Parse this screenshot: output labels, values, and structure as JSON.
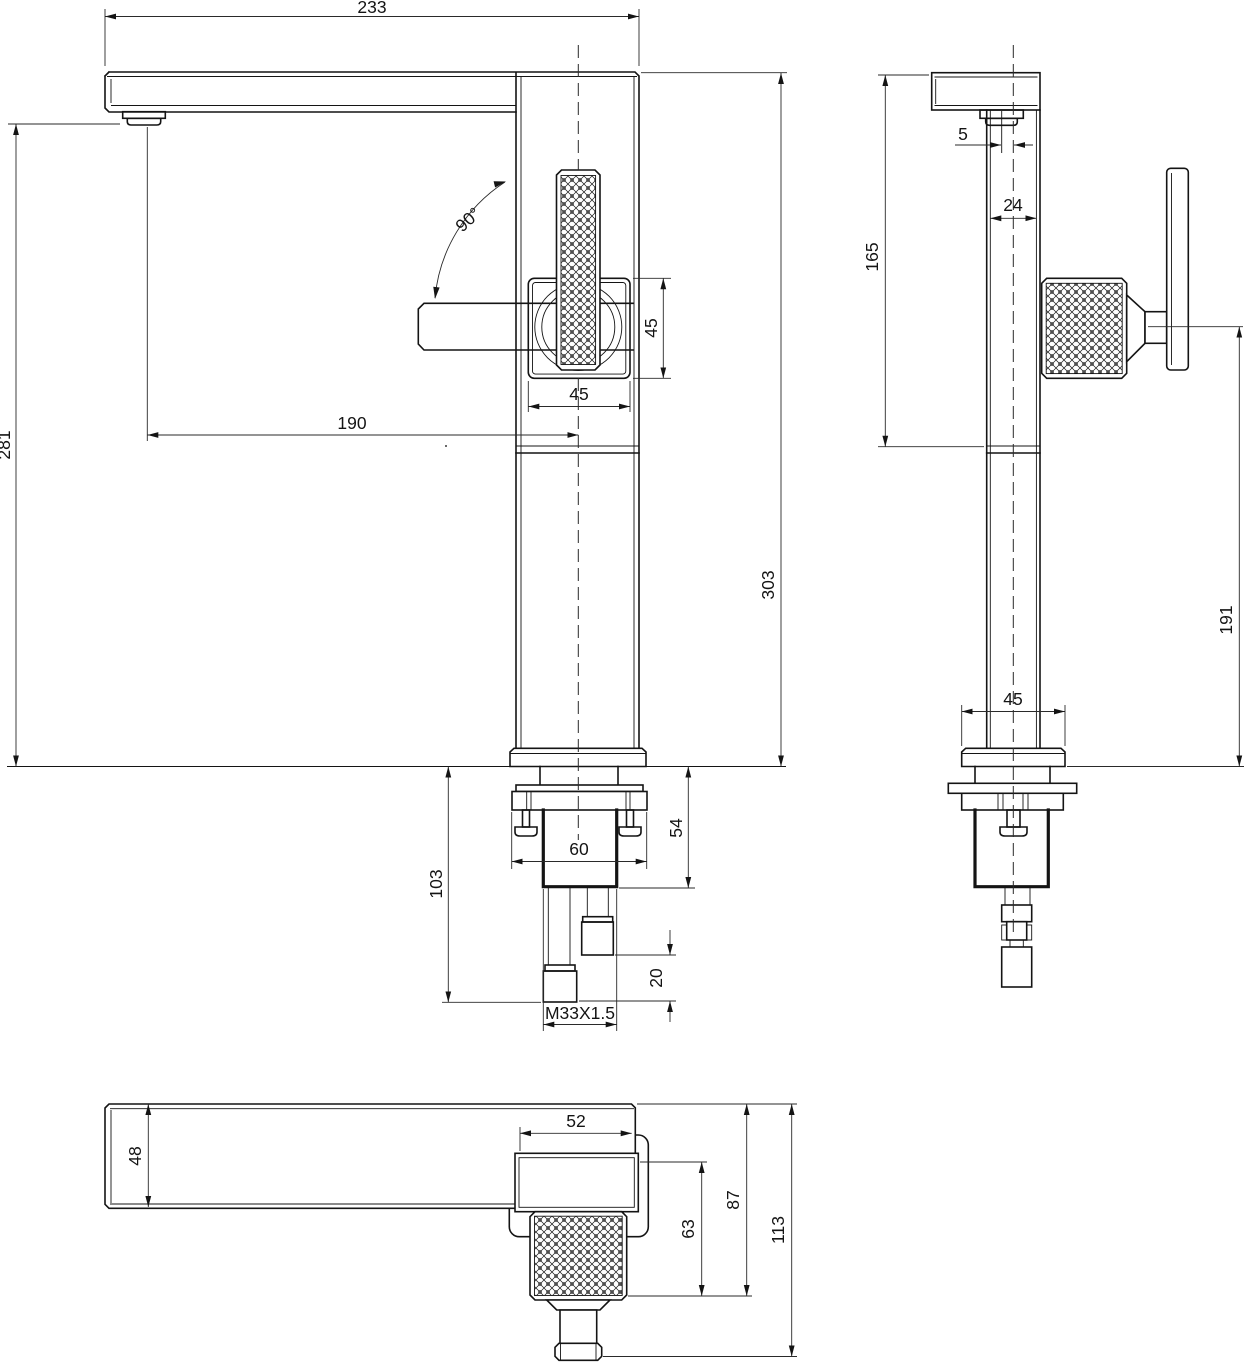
{
  "drawing": {
    "kind": "faucet-dimensional-drawing",
    "background": "#ffffff",
    "line_color": "#141414"
  },
  "front": {
    "dims": {
      "overall_width": "233",
      "height_to_outlet": "281",
      "overall_height": "303",
      "spout_reach": "190",
      "handle_square_height": "45",
      "handle_square_width": "45",
      "handle_rotation": "90°",
      "nut_width": "60",
      "under_counter_depth": "54",
      "hose_drop": "103",
      "fitting_length": "20",
      "thread_spec": "M33X1.5"
    }
  },
  "side": {
    "dims": {
      "upper_body_height": "165",
      "outlet_offset": "5",
      "body_depth": "24",
      "handle_center_height": "191",
      "flange_depth": "45"
    }
  },
  "top": {
    "dims": {
      "spout_depth": "48",
      "valve_body_width": "52",
      "knurl_extent": "63",
      "handle_extent": "87",
      "overall_extent": "113"
    }
  }
}
